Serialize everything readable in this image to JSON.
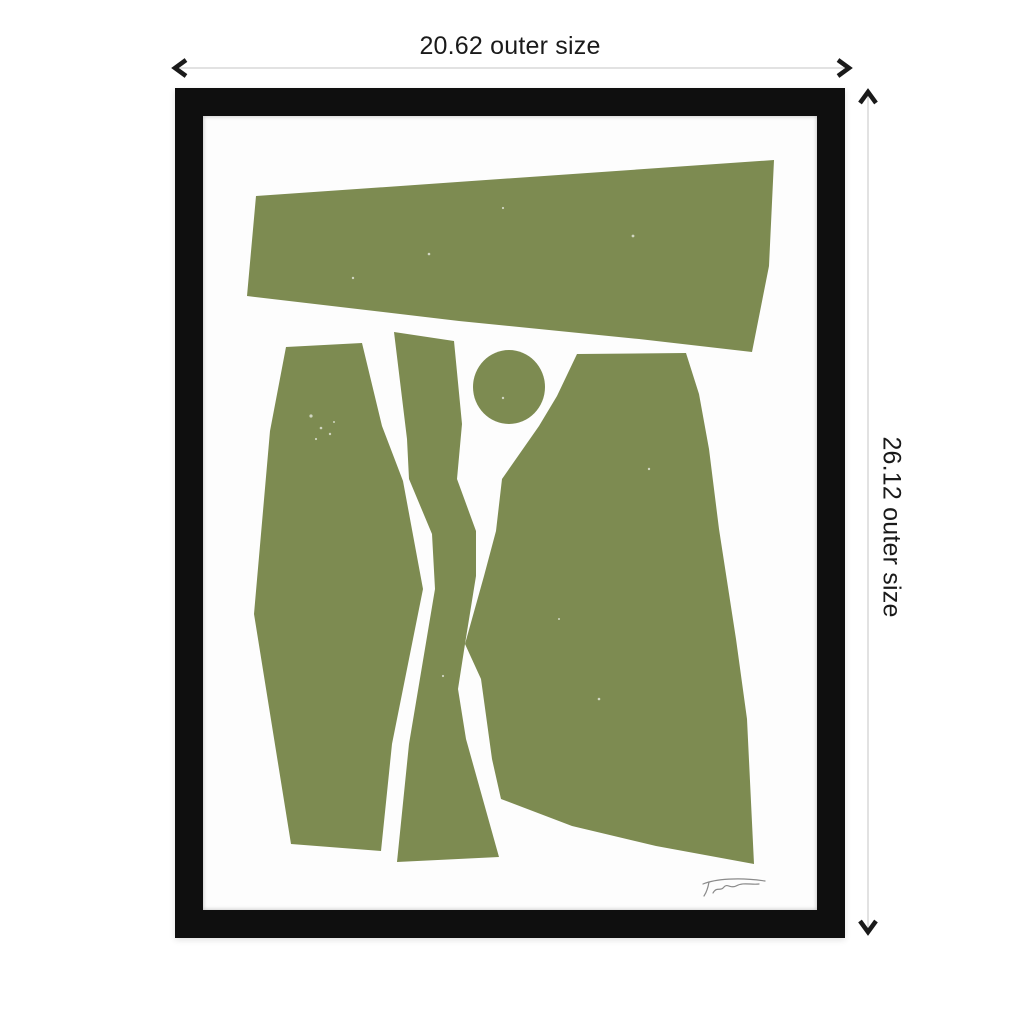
{
  "dimensions": {
    "width_label": "20.62 outer size",
    "height_label": "26.12 outer size",
    "line_color": "#d8d8d8",
    "arrow_color": "#1a1a1a",
    "text_color": "#1a1a1a"
  },
  "frame": {
    "color": "#0f0f0f",
    "mat_color": "#fdfdfd"
  },
  "artwork": {
    "style": "abstract cut-paper block print",
    "color": "#7d8b51",
    "background": "#fdfdfd",
    "signature_color": "#8a8a8a",
    "shapes": [
      {
        "name": "top-band",
        "type": "polygon",
        "points": "53,80 571,44 566,150 549,236 436,223 256,205 44,180"
      },
      {
        "name": "left-polygon",
        "type": "polygon",
        "points": "83,231 159,227 179,310 200,365 220,473 189,628 178,735 88,728 51,498 67,315"
      },
      {
        "name": "middle-strip",
        "type": "polygon",
        "points": "191,216 251,225 259,308 254,363 273,415 273,460 262,528 255,573 263,623 296,741 194,746 206,628 232,473 229,418 206,363 204,323"
      },
      {
        "name": "circle",
        "type": "ellipse",
        "cx": 306,
        "cy": 271,
        "rx": 36,
        "ry": 37
      },
      {
        "name": "right-polygon",
        "type": "polygon",
        "points": "374,238 483,237 496,278 506,333 516,413 533,523 544,603 551,748 453,730 369,710 298,683 289,643 278,563 262,528 281,460 293,415 299,363 336,310 354,280"
      }
    ],
    "speckles": [
      [
        108,
        300,
        1.6
      ],
      [
        118,
        312,
        1.3
      ],
      [
        127,
        318,
        1.2
      ],
      [
        113,
        323,
        1.1
      ],
      [
        131,
        306,
        1.0
      ],
      [
        226,
        138,
        1.3
      ],
      [
        300,
        92,
        1.1
      ],
      [
        150,
        162,
        1.2
      ],
      [
        430,
        120,
        1.4
      ],
      [
        446,
        353,
        1.2
      ],
      [
        396,
        583,
        1.3
      ],
      [
        356,
        503,
        1.0
      ],
      [
        300,
        282,
        1.2
      ],
      [
        240,
        560,
        1.1
      ]
    ],
    "signature_paths": [
      "M500,768 C512,763 536,761 562,765",
      "M506,766 C505,772 503,777 501,780",
      "M510,777 C514,770 517,776 521,771 C524,767 528,773 533,770 C540,766 548,769 556,768"
    ]
  }
}
